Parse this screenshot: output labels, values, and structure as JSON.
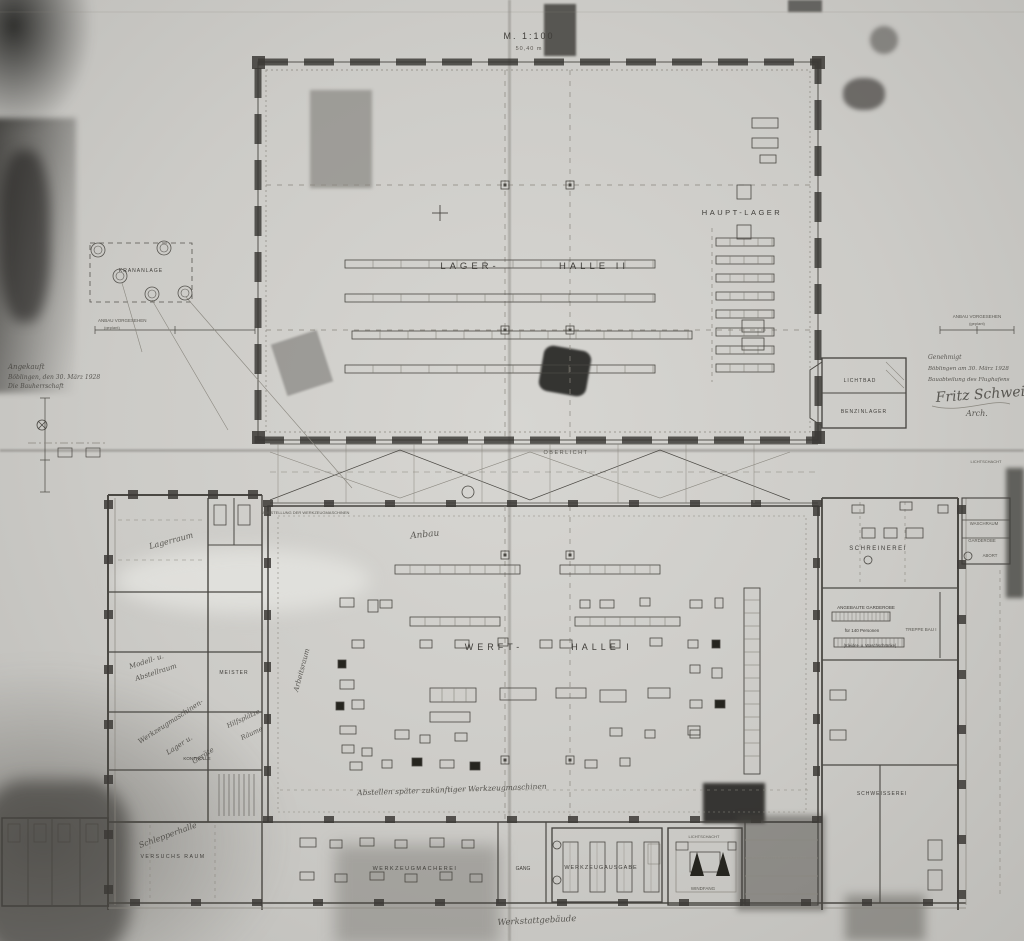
{
  "plan": {
    "scale": {
      "main": "M. 1:100",
      "sub": "50,40 m"
    },
    "halls": {
      "lager_left": "LAGER-",
      "lager_right": "HALLE II",
      "haupt_lager": "HAUPT-LAGER",
      "werft_left": "WERFT-",
      "werft_right": "HALLE I",
      "oberlicht": "OBERLICHT"
    },
    "rooms": {
      "schreinerei": "SCHREINEREI",
      "waschraum": "WASCHRAUM",
      "garderobe_klein": "GARDEROBE",
      "abort": "ABORT",
      "lichtschacht_ost": "LICHTSCHACHT",
      "lichtbad": "LICHTBAD",
      "benzinlager": "BENZINLAGER",
      "garderobe_zeile1": "ANGEBAUTE GARDEROBE",
      "garderobe_zeile2": "für 140 Personen",
      "garderobe_zeile3": "(Kleider- u. Waschschränke)",
      "treppe": "TREPPE BAU I",
      "schweisserei": "SCHWEISSEREI",
      "meister": "MEISTER",
      "kontrolle": "KONTROLLE",
      "versuchsraum": "VERSUCHS RAUM",
      "werkzeugmacherei": "WERKZEUGMACHEREI",
      "gang": "GANG",
      "werkzeugausgabe": "WERKZEUGAUSGABE",
      "lichtschacht": "LICHTSCHACHT",
      "windfang": "WINDFANG",
      "oelkeller": "ANGEBAUTER OELKELLER",
      "maschinenliste": "AUFSTELLUNG DER WERKZEUGMASCHINEN"
    },
    "notes": {
      "krananlage": "KRANANLAGE",
      "anbau_links_1": "ANBAU VORGESEHEN",
      "anbau_links_2": "(geplant)",
      "anbau_rechts_1": "ANBAU VORGESEHEN",
      "anbau_rechts_2": "(geplant)"
    },
    "handwritten": {
      "lagerraum": "Lagerraum",
      "modell_1": "Modell- u.",
      "modell_2": "Abstellraum",
      "wzm_1": "Werkzeugmaschinen-",
      "wzm_2": "Lager u.",
      "wzm_3": "Geräte",
      "hilfs_1": "Hilfsplätze",
      "hilfs_2": "Räume",
      "arbeitsraum": "Arbeitsraum",
      "schlepper": "Schlepperhalle",
      "maschinen_notiz": "Abstellen später zukünftiger Werkzeugmaschinen",
      "werkstatt": "Werkstattgebäude",
      "mitte": "Anbau"
    },
    "stamps": {
      "angekauft": [
        "Angekauft",
        "Böblingen, den 30. März 1928",
        "Die Bauherrschaft"
      ],
      "genehmigt": [
        "Genehmigt",
        "Böblingen am 30. März 1928",
        "Bauabteilung des Flughafens"
      ],
      "unterschrift": "Fritz Schweizer",
      "unterschrift_zusatz": "Arch."
    }
  }
}
